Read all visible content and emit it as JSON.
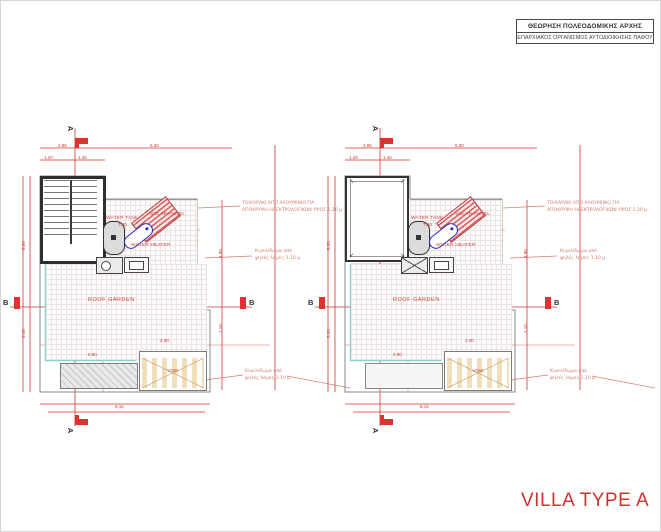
{
  "approval": {
    "line1": "ΘΕΩΡΗΣΗ ΠΟΛΕΟΔΟΜΙΚΗΣ ΑΡΧΗΣ",
    "line2": "ΕΠΑΡΧΙΑΚΟΣ ΟΡΓΑΝΙΣΜΟΣ ΑΥΤΟΔΙΟΙΚΗΣΗΣ ΠΑΦΟΥ"
  },
  "title": "VILLA TYPE A",
  "plan_labels": {
    "roof_garden": "ROOF GARDEN",
    "water_tank": "WATER TANK",
    "solar_panel": "SOLAR PANEL",
    "water_heater": "WATER HEATER",
    "void": "VOID"
  },
  "section_markers": {
    "a": "A",
    "b": "B"
  },
  "notes": {
    "screen_line1": "ΤΟΙΧΑΡΑΚΙ ΑΠΟ ΑΛΟΥΜΙΝΙΟ ΓΙΑ",
    "screen_line2": "ΑΠΟΚΡΥΨΗ ΗΛΕΚΤΡΟΛΟΓΙΚΩΝ ΥΨΟΣ 1.20 μ",
    "railing_line1": "Κιγκλίδωμα από",
    "railing_line2": "ψηλές λάμες 1.10 μ"
  },
  "dimensions": [
    "2.85",
    "5.30",
    "1.20",
    "1.45",
    "8.20",
    "3.10",
    "8.15",
    "4.90",
    "1.10",
    "7.00",
    "2.30",
    "0.90"
  ],
  "colors": {
    "dim_red": "#cf3333",
    "note_salmon": "#cf7d76",
    "railing_cyan": "#86d2d2",
    "wall_dark": "#2e2e2e",
    "panel_red": "#d86060",
    "heater_blue": "#2626bb",
    "void_tan": "#c9a262",
    "title_red": "#d2322e"
  }
}
